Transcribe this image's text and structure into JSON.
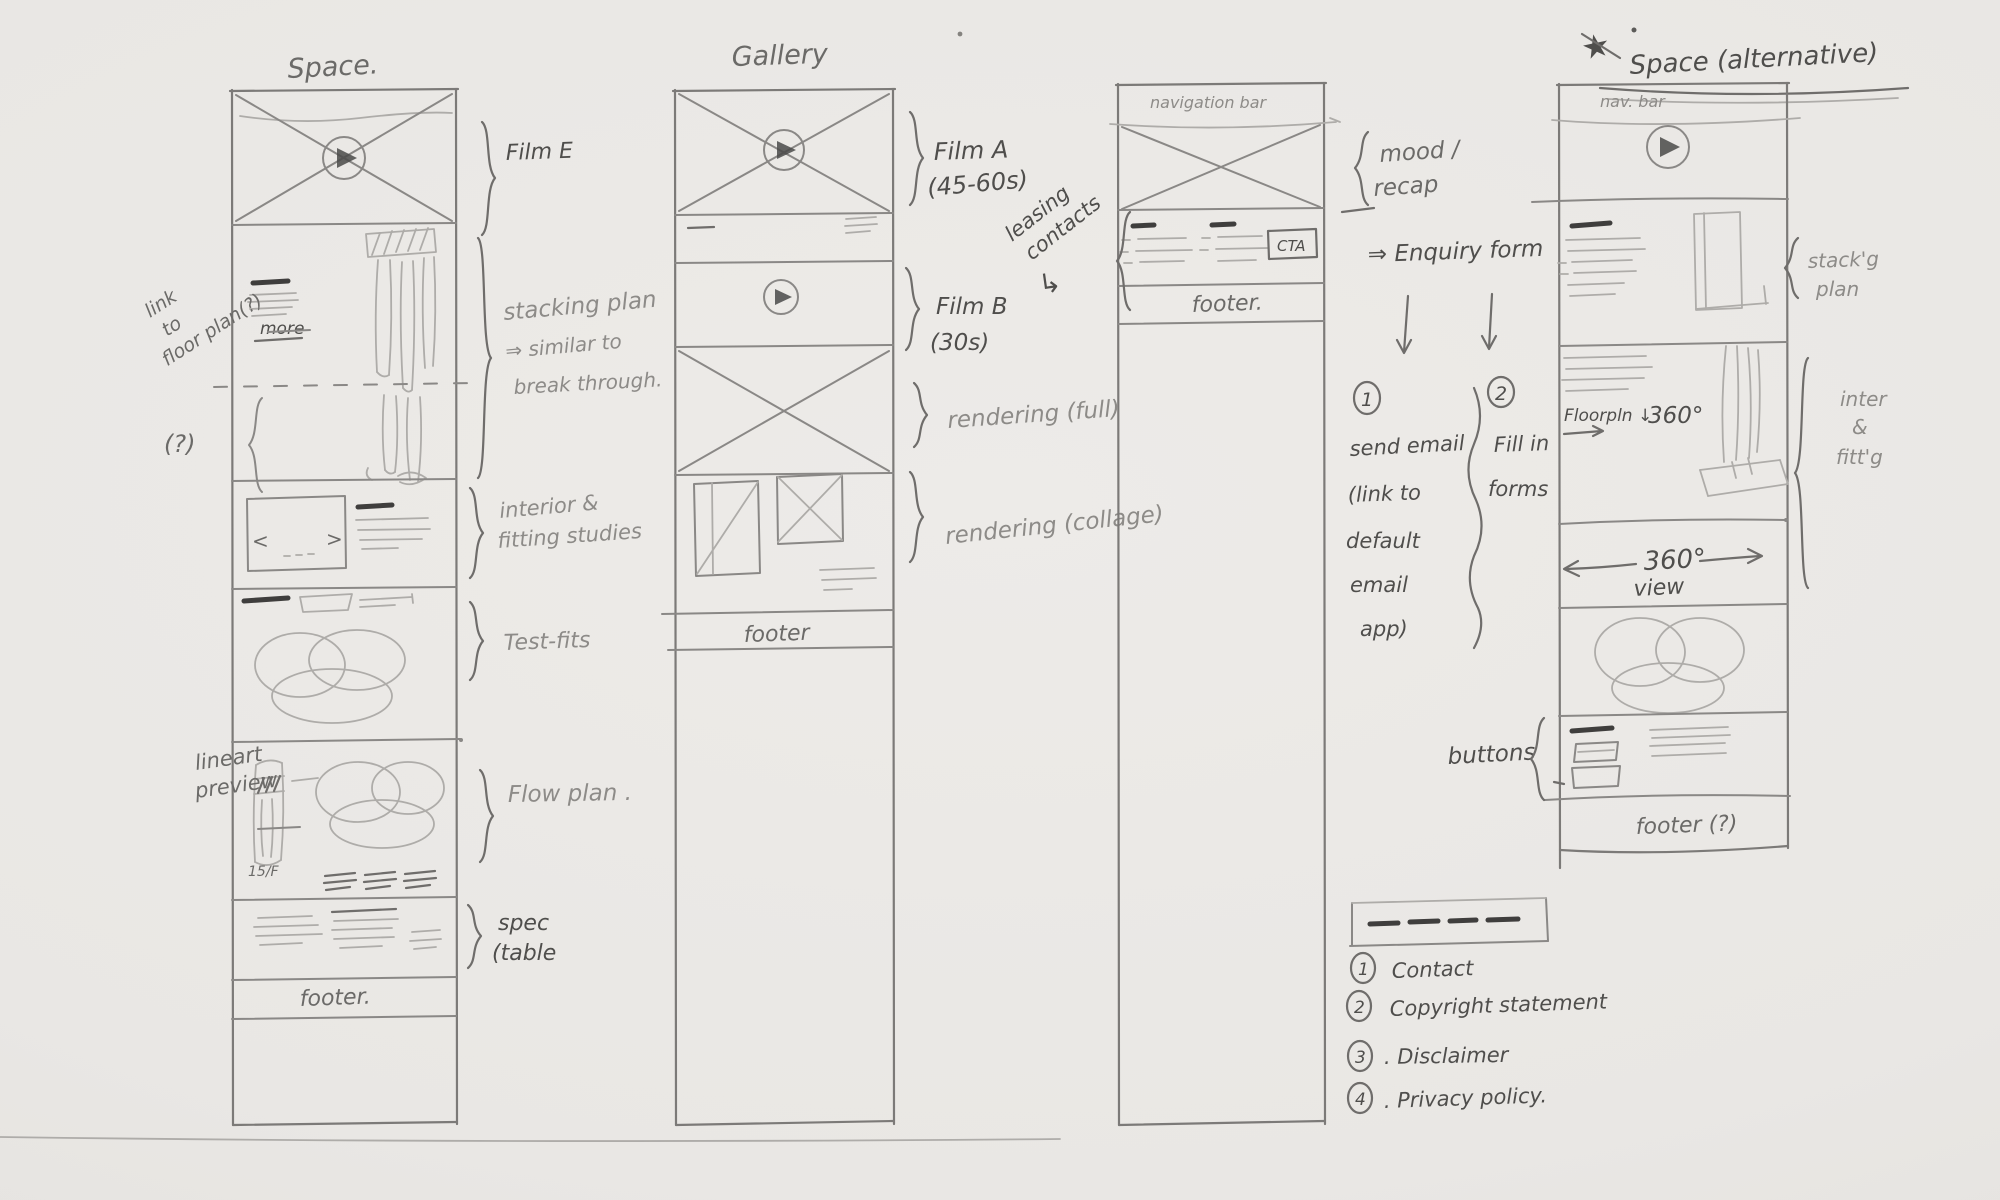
{
  "c1": {
    "title": "Space.",
    "ann_link_1": "link",
    "ann_link_2": "to",
    "ann_link_3": "floor plan(?)",
    "more": "more",
    "q": "(?)",
    "film_e": "Film E",
    "stack_1": "stacking plan",
    "stack_2": "⇒ similar to",
    "stack_3": "break through.",
    "int_1": "interior &",
    "int_2": "fitting studies",
    "testfits": "Test-fits",
    "lineart_1": "lineart",
    "lineart_2": "preview",
    "floor": "15/F",
    "flow": "Flow plan .",
    "spec_1": "spec",
    "spec_2": "(table",
    "footer": "footer."
  },
  "c2": {
    "title": "Gallery",
    "film_a_1": "Film A",
    "film_a_2": "(45-60s)",
    "film_b_1": "Film B",
    "film_b_2": "(30s)",
    "rend_full": "rendering (full)",
    "rend_collage": "rendering (collage)",
    "footer": "footer"
  },
  "c3": {
    "nav": "navigation bar",
    "leasing_1": "leasing",
    "leasing_2": "contacts",
    "leasing_arrow": "↳",
    "cta": "CTA",
    "footer": "footer.",
    "mood_1": "mood /",
    "mood_2": "recap",
    "enquiry": "⇒ Enquiry form",
    "opt1_num": "1",
    "opt1_l1": "send email",
    "opt1_l2": "(link to",
    "opt1_l3": "default",
    "opt1_l4": "email",
    "opt1_l5": "app)",
    "opt2_num": "2",
    "opt2_l1": "Fill in",
    "opt2_l2": "forms",
    "f1_num": "1",
    "f1": "Contact",
    "f2_num": "2",
    "f2": "Copyright statement",
    "f3_num": "3",
    "f3": ". Disclaimer",
    "f4_num": "4",
    "f4": ". Privacy policy."
  },
  "c4": {
    "star": "★",
    "title": "Space (alternative)",
    "nav": "nav. bar",
    "stack_1": "stack'g",
    "stack_2": "plan",
    "fp": "Floorpln ↓",
    "fp_deg": "360°",
    "inter_1": "inter",
    "inter_2": "&",
    "inter_3": "fitt'g",
    "deg": "360°",
    "view": "view",
    "buttons": "buttons",
    "footer": "footer (?)"
  }
}
